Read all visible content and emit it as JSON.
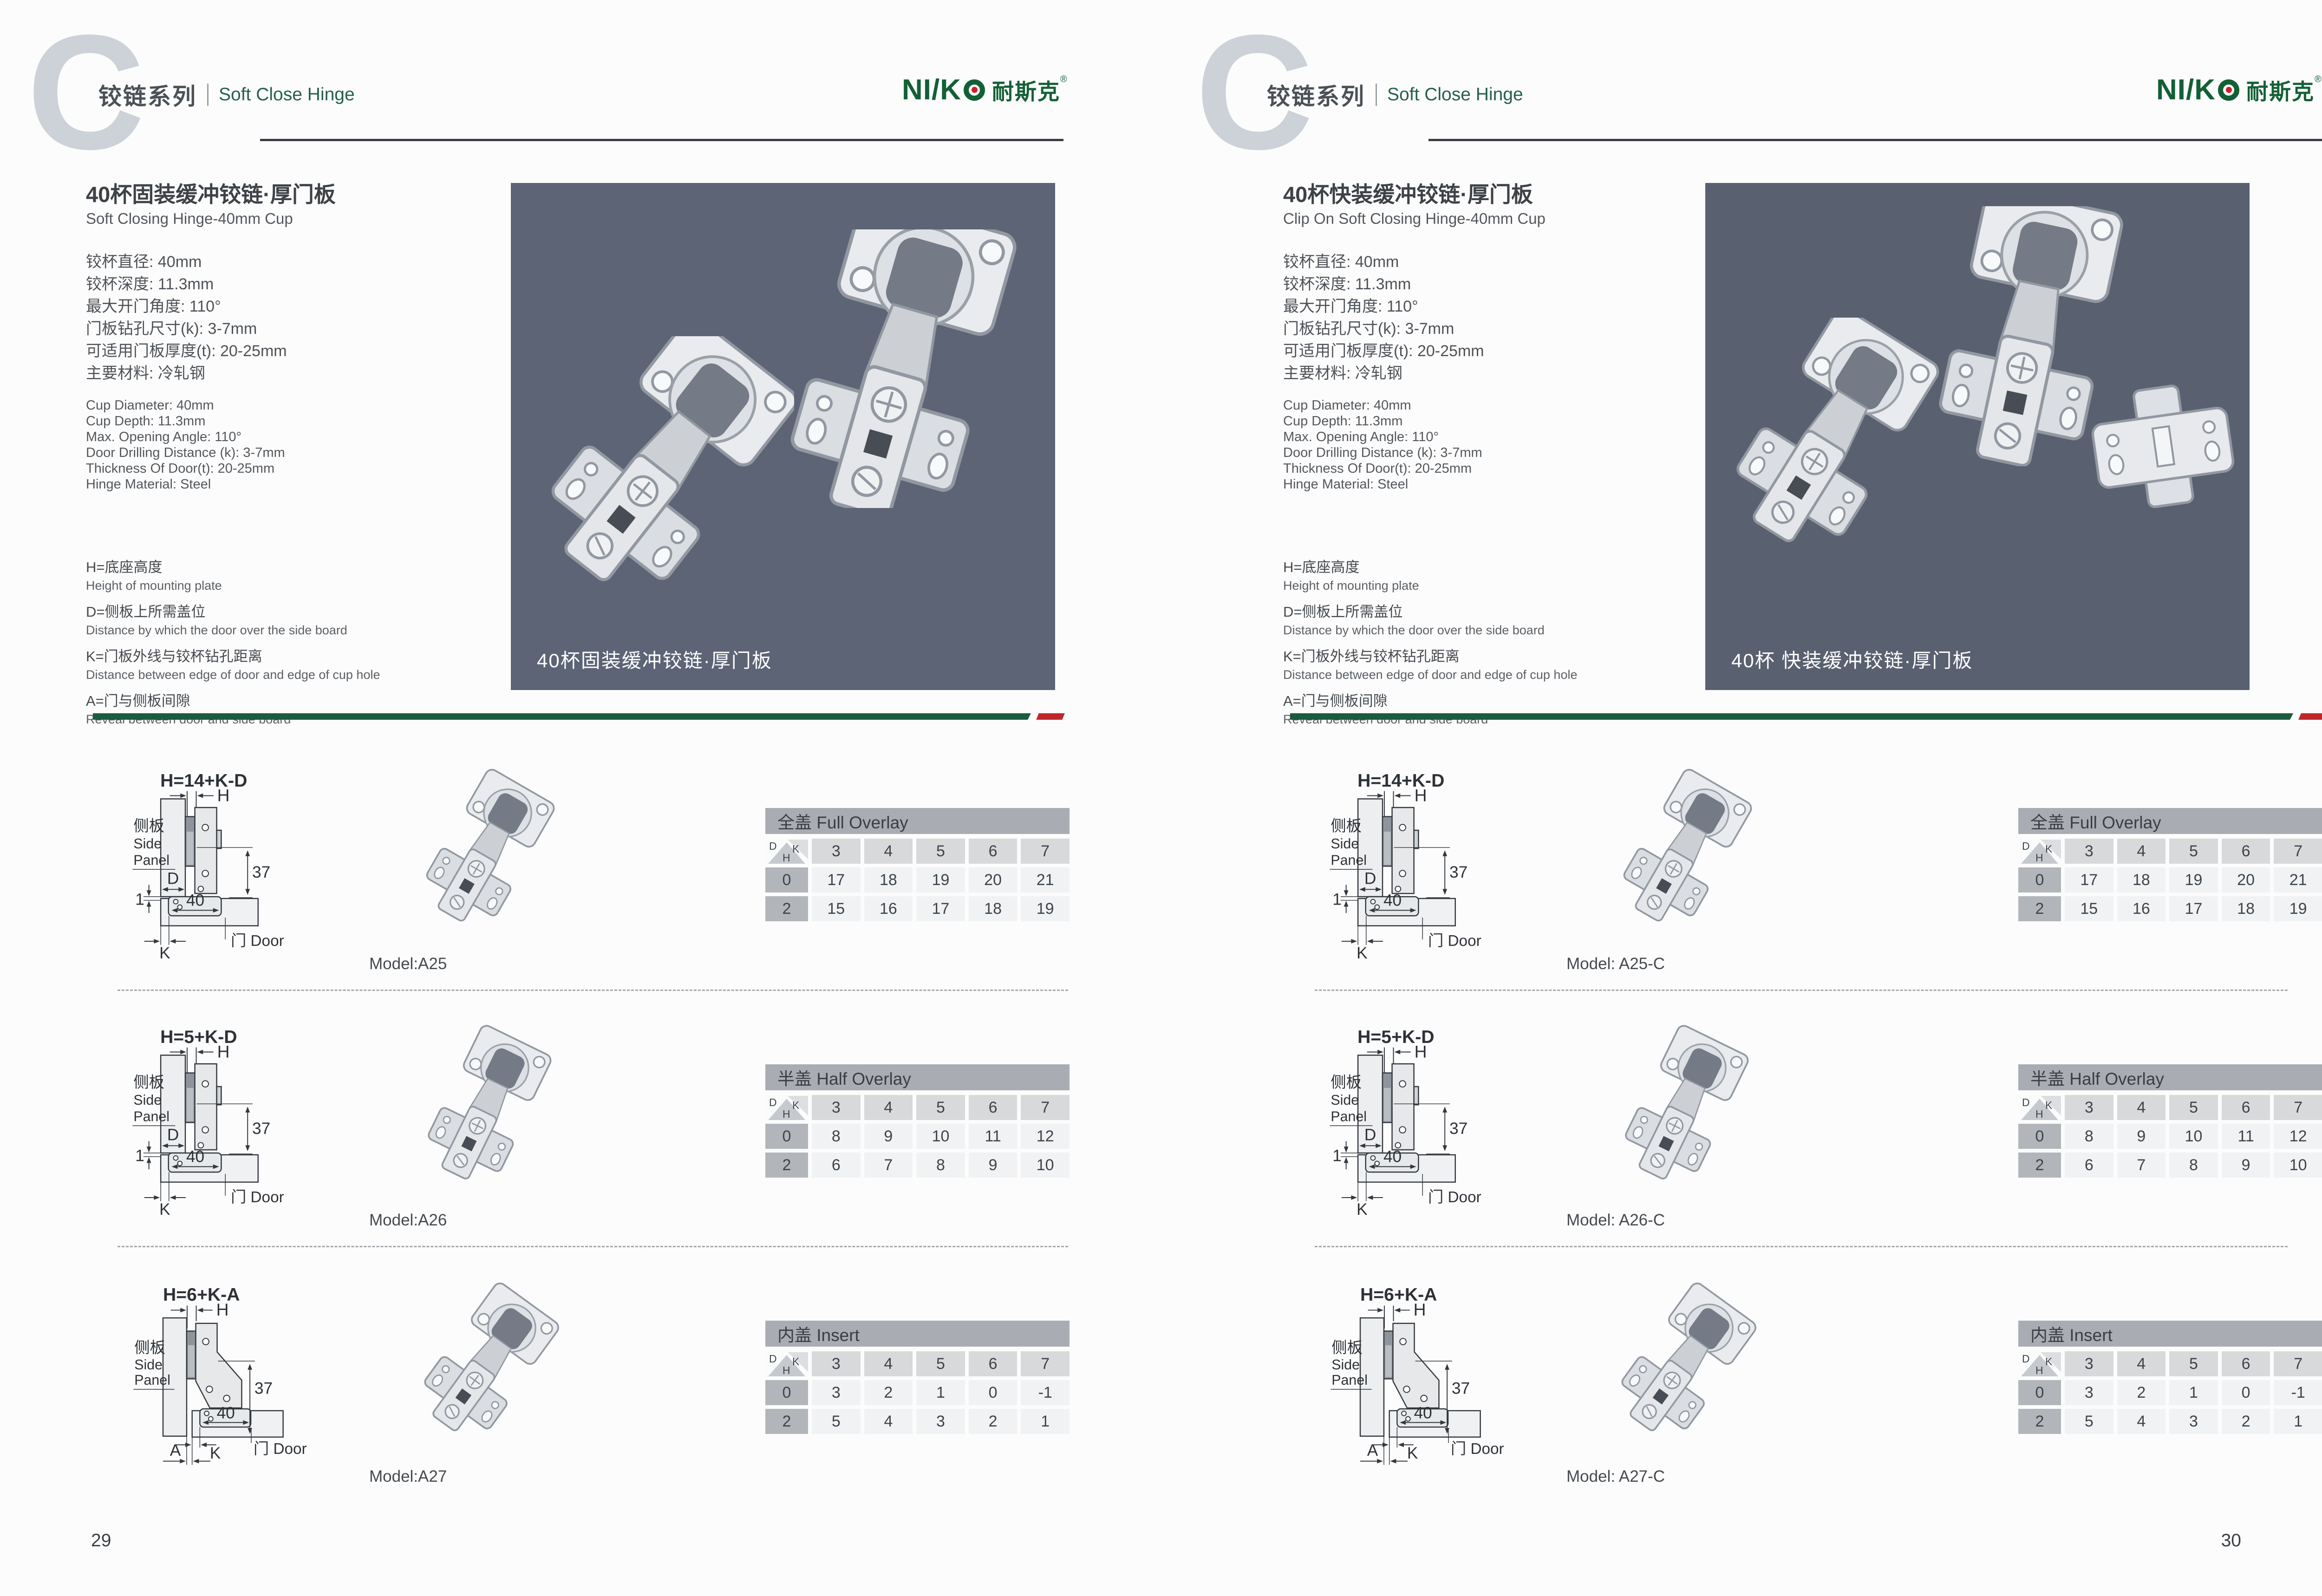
{
  "header": {
    "watermark": "C",
    "series_cn": "铰链系列",
    "series_en": "Soft Close Hinge",
    "brand_latin": "NI/K",
    "brand_cn": "耐斯克",
    "brand_reg": "®"
  },
  "colors": {
    "brand_green": "#136036",
    "logo_dot_red": "#d01f27",
    "separator_green": "#1d5b41",
    "separator_red": "#c0272d"
  },
  "pages": [
    {
      "page_number": "29",
      "title_cn": "40杯固装缓冲铰链·厚门板",
      "title_en": "Soft Closing Hinge-40mm Cup",
      "specs_cn": [
        "铰杯直径: 40mm",
        "铰杯深度: 11.3mm",
        "最大开门角度: 110°",
        "门板钻孔尺寸(k): 3-7mm",
        "可适用门板厚度(t): 20-25mm",
        "主要材料: 冷轧钢"
      ],
      "specs_en": [
        "Cup Diameter: 40mm",
        "Cup Depth: 11.3mm",
        "Max. Opening Angle: 110°",
        "Door Drilling Distance (k): 3-7mm",
        "Thickness Of Door(t): 20-25mm",
        "Hinge Material: Steel"
      ],
      "legend": [
        {
          "term": "H=底座高度",
          "desc": "Height of mounting plate"
        },
        {
          "term": "D=侧板上所需盖位",
          "desc": "Distance by which the door over the side board"
        },
        {
          "term": "K=门板外线与铰杯钻孔距离",
          "desc": "Distance between edge of door and edge of cup hole"
        },
        {
          "term": "A=门与侧板间隙",
          "desc": "Reveal between door and side board"
        }
      ],
      "photo_caption": "40杯固装缓冲铰链·厚门板",
      "photo_bg": "#5c6476",
      "photo_items": [
        "soft-close-hinge",
        "soft-close-hinge"
      ],
      "diagram_labels": {
        "side_cn": "侧板",
        "side_en1": "Side",
        "side_en2": "Panel",
        "h": "H",
        "d": "D",
        "k": "K",
        "a": "A",
        "one": "1",
        "dim37": "37",
        "dim40": "40",
        "door": "门 Door"
      },
      "sections": [
        {
          "formula": "H=14+K-D",
          "model": "Model:A25",
          "variant": "overlay",
          "table": {
            "title": "全盖 Full Overlay",
            "corner": {
              "d": "D",
              "k": "K",
              "h": "H"
            },
            "columns": [
              "3",
              "4",
              "5",
              "6",
              "7"
            ],
            "rows": [
              {
                "h": "0",
                "values": [
                  "17",
                  "18",
                  "19",
                  "20",
                  "21"
                ]
              },
              {
                "h": "2",
                "values": [
                  "15",
                  "16",
                  "17",
                  "18",
                  "19"
                ]
              }
            ]
          }
        },
        {
          "formula": "H=5+K-D",
          "model": "Model:A26",
          "variant": "overlay",
          "table": {
            "title": "半盖 Half Overlay",
            "corner": {
              "d": "D",
              "k": "K",
              "h": "H"
            },
            "columns": [
              "3",
              "4",
              "5",
              "6",
              "7"
            ],
            "rows": [
              {
                "h": "0",
                "values": [
                  "8",
                  "9",
                  "10",
                  "11",
                  "12"
                ]
              },
              {
                "h": "2",
                "values": [
                  "6",
                  "7",
                  "8",
                  "9",
                  "10"
                ]
              }
            ]
          }
        },
        {
          "formula": "H=6+K-A",
          "model": "Model:A27",
          "variant": "insert",
          "table": {
            "title": "内盖 Insert",
            "corner": {
              "d": "D",
              "k": "K",
              "h": "H"
            },
            "columns": [
              "3",
              "4",
              "5",
              "6",
              "7"
            ],
            "rows": [
              {
                "h": "0",
                "values": [
                  "3",
                  "2",
                  "1",
                  "0",
                  "-1"
                ]
              },
              {
                "h": "2",
                "values": [
                  "5",
                  "4",
                  "3",
                  "2",
                  "1"
                ]
              }
            ]
          }
        }
      ]
    },
    {
      "page_number": "30",
      "title_cn": "40杯快装缓冲铰链·厚门板",
      "title_en": "Clip On Soft Closing Hinge-40mm Cup",
      "specs_cn": [
        "铰杯直径: 40mm",
        "铰杯深度: 11.3mm",
        "最大开门角度: 110°",
        "门板钻孔尺寸(k): 3-7mm",
        "可适用门板厚度(t): 20-25mm",
        "主要材料: 冷轧钢"
      ],
      "specs_en": [
        "Cup Diameter: 40mm",
        "Cup Depth: 11.3mm",
        "Max. Opening Angle: 110°",
        "Door Drilling Distance (k): 3-7mm",
        "Thickness Of Door(t): 20-25mm",
        "Hinge Material: Steel"
      ],
      "legend": [
        {
          "term": "H=底座高度",
          "desc": "Height of mounting plate"
        },
        {
          "term": "D=侧板上所需盖位",
          "desc": "Distance by which the door over the side board"
        },
        {
          "term": "K=门板外线与铰杯钻孔距离",
          "desc": "Distance between edge of door and edge of cup hole"
        },
        {
          "term": "A=门与侧板间隙",
          "desc": "Reveal between door and side board"
        }
      ],
      "photo_caption": "40杯 快装缓冲铰链·厚门板",
      "photo_bg": "#596070",
      "photo_items": [
        "soft-close-hinge",
        "soft-close-hinge-open",
        "mounting-plate"
      ],
      "diagram_labels": {
        "side_cn": "侧板",
        "side_en1": "Side",
        "side_en2": "Panel",
        "h": "H",
        "d": "D",
        "k": "K",
        "a": "A",
        "one": "1",
        "dim37": "37",
        "dim40": "40",
        "door": "门 Door"
      },
      "sections": [
        {
          "formula": "H=14+K-D",
          "model": "Model: A25-C",
          "variant": "overlay",
          "table": {
            "title": "全盖 Full Overlay",
            "corner": {
              "d": "D",
              "k": "K",
              "h": "H"
            },
            "columns": [
              "3",
              "4",
              "5",
              "6",
              "7"
            ],
            "rows": [
              {
                "h": "0",
                "values": [
                  "17",
                  "18",
                  "19",
                  "20",
                  "21"
                ]
              },
              {
                "h": "2",
                "values": [
                  "15",
                  "16",
                  "17",
                  "18",
                  "19"
                ]
              }
            ]
          }
        },
        {
          "formula": "H=5+K-D",
          "model": "Model: A26-C",
          "variant": "overlay",
          "table": {
            "title": "半盖 Half Overlay",
            "corner": {
              "d": "D",
              "k": "K",
              "h": "H"
            },
            "columns": [
              "3",
              "4",
              "5",
              "6",
              "7"
            ],
            "rows": [
              {
                "h": "0",
                "values": [
                  "8",
                  "9",
                  "10",
                  "11",
                  "12"
                ]
              },
              {
                "h": "2",
                "values": [
                  "6",
                  "7",
                  "8",
                  "9",
                  "10"
                ]
              }
            ]
          }
        },
        {
          "formula": "H=6+K-A",
          "model": "Model: A27-C",
          "variant": "insert",
          "table": {
            "title": "内盖 Insert",
            "corner": {
              "d": "D",
              "k": "K",
              "h": "H"
            },
            "columns": [
              "3",
              "4",
              "5",
              "6",
              "7"
            ],
            "rows": [
              {
                "h": "0",
                "values": [
                  "3",
                  "2",
                  "1",
                  "0",
                  "-1"
                ]
              },
              {
                "h": "2",
                "values": [
                  "5",
                  "4",
                  "3",
                  "2",
                  "1"
                ]
              }
            ]
          }
        }
      ]
    }
  ]
}
